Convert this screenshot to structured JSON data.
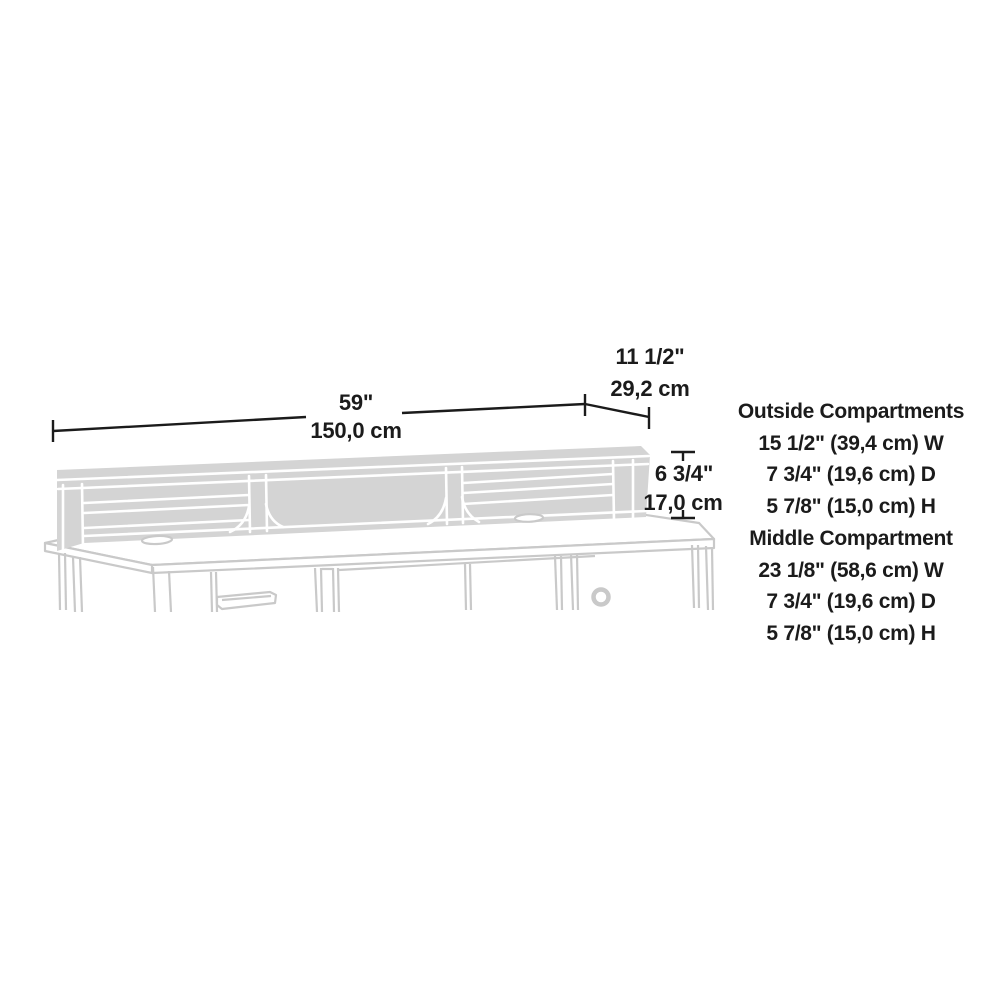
{
  "diagram": {
    "kind": "product-dimension-diagram",
    "subject": "desk hutch organizer with two outside compartments and open middle compartment on a desk"
  },
  "dimension_labels": {
    "width_in": "59\"",
    "width_cm": "150,0 cm",
    "depth_in": "11 1/2\"",
    "depth_cm": "29,2 cm",
    "height_in": "6 3/4\"",
    "height_cm": "17,0 cm"
  },
  "specs": {
    "outside": {
      "title": "Outside Compartments",
      "w": "15 1/2\" (39,4 cm) W",
      "d": "7 3/4\" (19,6 cm) D",
      "h": "5 7/8\" (15,0 cm) H"
    },
    "middle": {
      "title": "Middle Compartment",
      "w": "23 1/8\" (58,6 cm) W",
      "d": "7 3/4\" (19,6 cm) D",
      "h": "5 7/8\" (15,0 cm) H"
    }
  },
  "colors": {
    "text": "#1b1b1b",
    "dimension_line": "#1b1b1b",
    "drawing_fill": "#d4d4d4",
    "drawing_stroke": "#c9c9c9",
    "background": "#ffffff"
  }
}
